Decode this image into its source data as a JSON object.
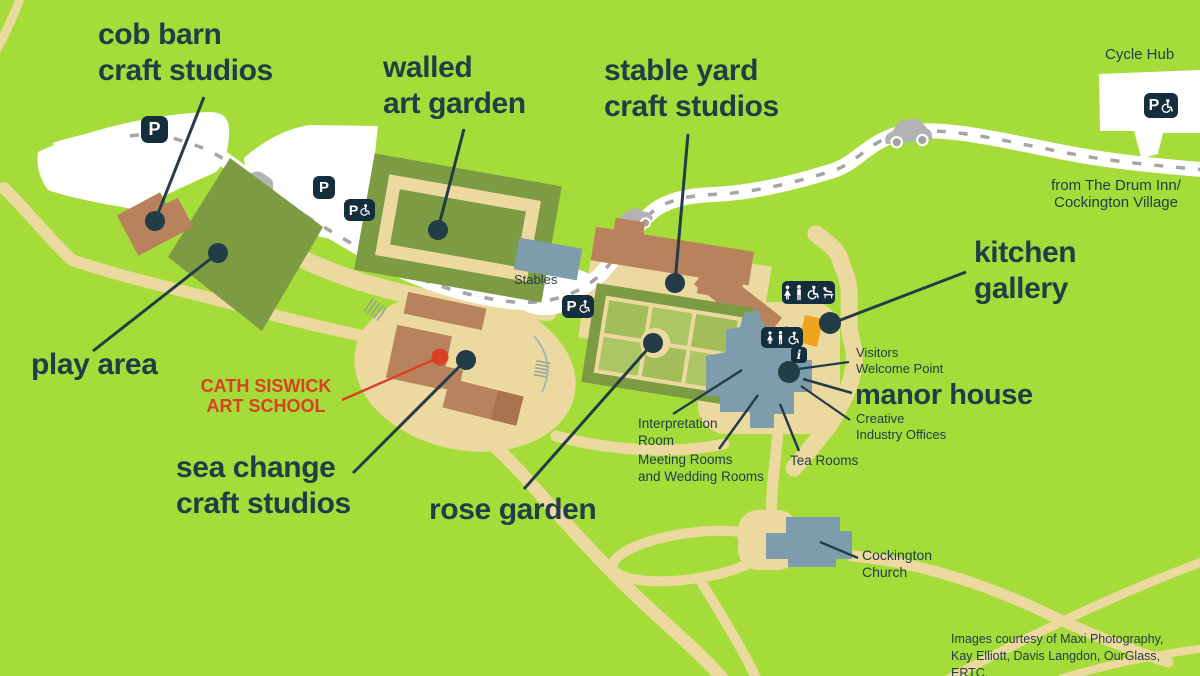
{
  "map": {
    "labels": {
      "cob_barn": "cob barn\ncraft studios",
      "walled_garden": "walled\nart garden",
      "stable_yard": "stable yard\ncraft studios",
      "play_area": "play area",
      "sea_change": "sea change\ncraft studios",
      "rose_garden": "rose garden",
      "kitchen_gallery": "kitchen\ngallery",
      "manor_house": "manor house",
      "cath_siswick": "CATH SISWICK\nART SCHOOL",
      "cycle_hub": "Cycle Hub",
      "from_drum_inn": "from The Drum Inn/\nCockington Village",
      "stables": "Stables",
      "visitors_welcome_point": "Visitors\nWelcome Point",
      "creative_industry_offices": "Creative\nIndustry Offices",
      "interpretation_room": "Interpretation\nRoom",
      "meeting_wedding_rooms": "Meeting Rooms\nand Wedding Rooms",
      "tea_rooms": "Tea Rooms",
      "cockington_church": "Cockington\nChurch",
      "credits": "Images courtesy of Maxi Photography,\nKay Elliott, Davis Langdon, OurGlass, ERTC."
    },
    "icons": {
      "parking": "P",
      "info": "i"
    },
    "colors": {
      "background": "#a6dc39",
      "label_text": "#223d45",
      "highlight_red": "#d94127",
      "building_brown": "#b8835c",
      "garden_olive": "#7d9b43",
      "garden_cell_green": "#a9c05e",
      "path_cream": "#ecd9a0",
      "building_bluegray": "#7e9dac",
      "kitchen_orange": "#f0a41c",
      "icon_navy": "#152e3d",
      "road_white": "#ffffff",
      "road_dash_gray": "#a5a5a5"
    }
  }
}
